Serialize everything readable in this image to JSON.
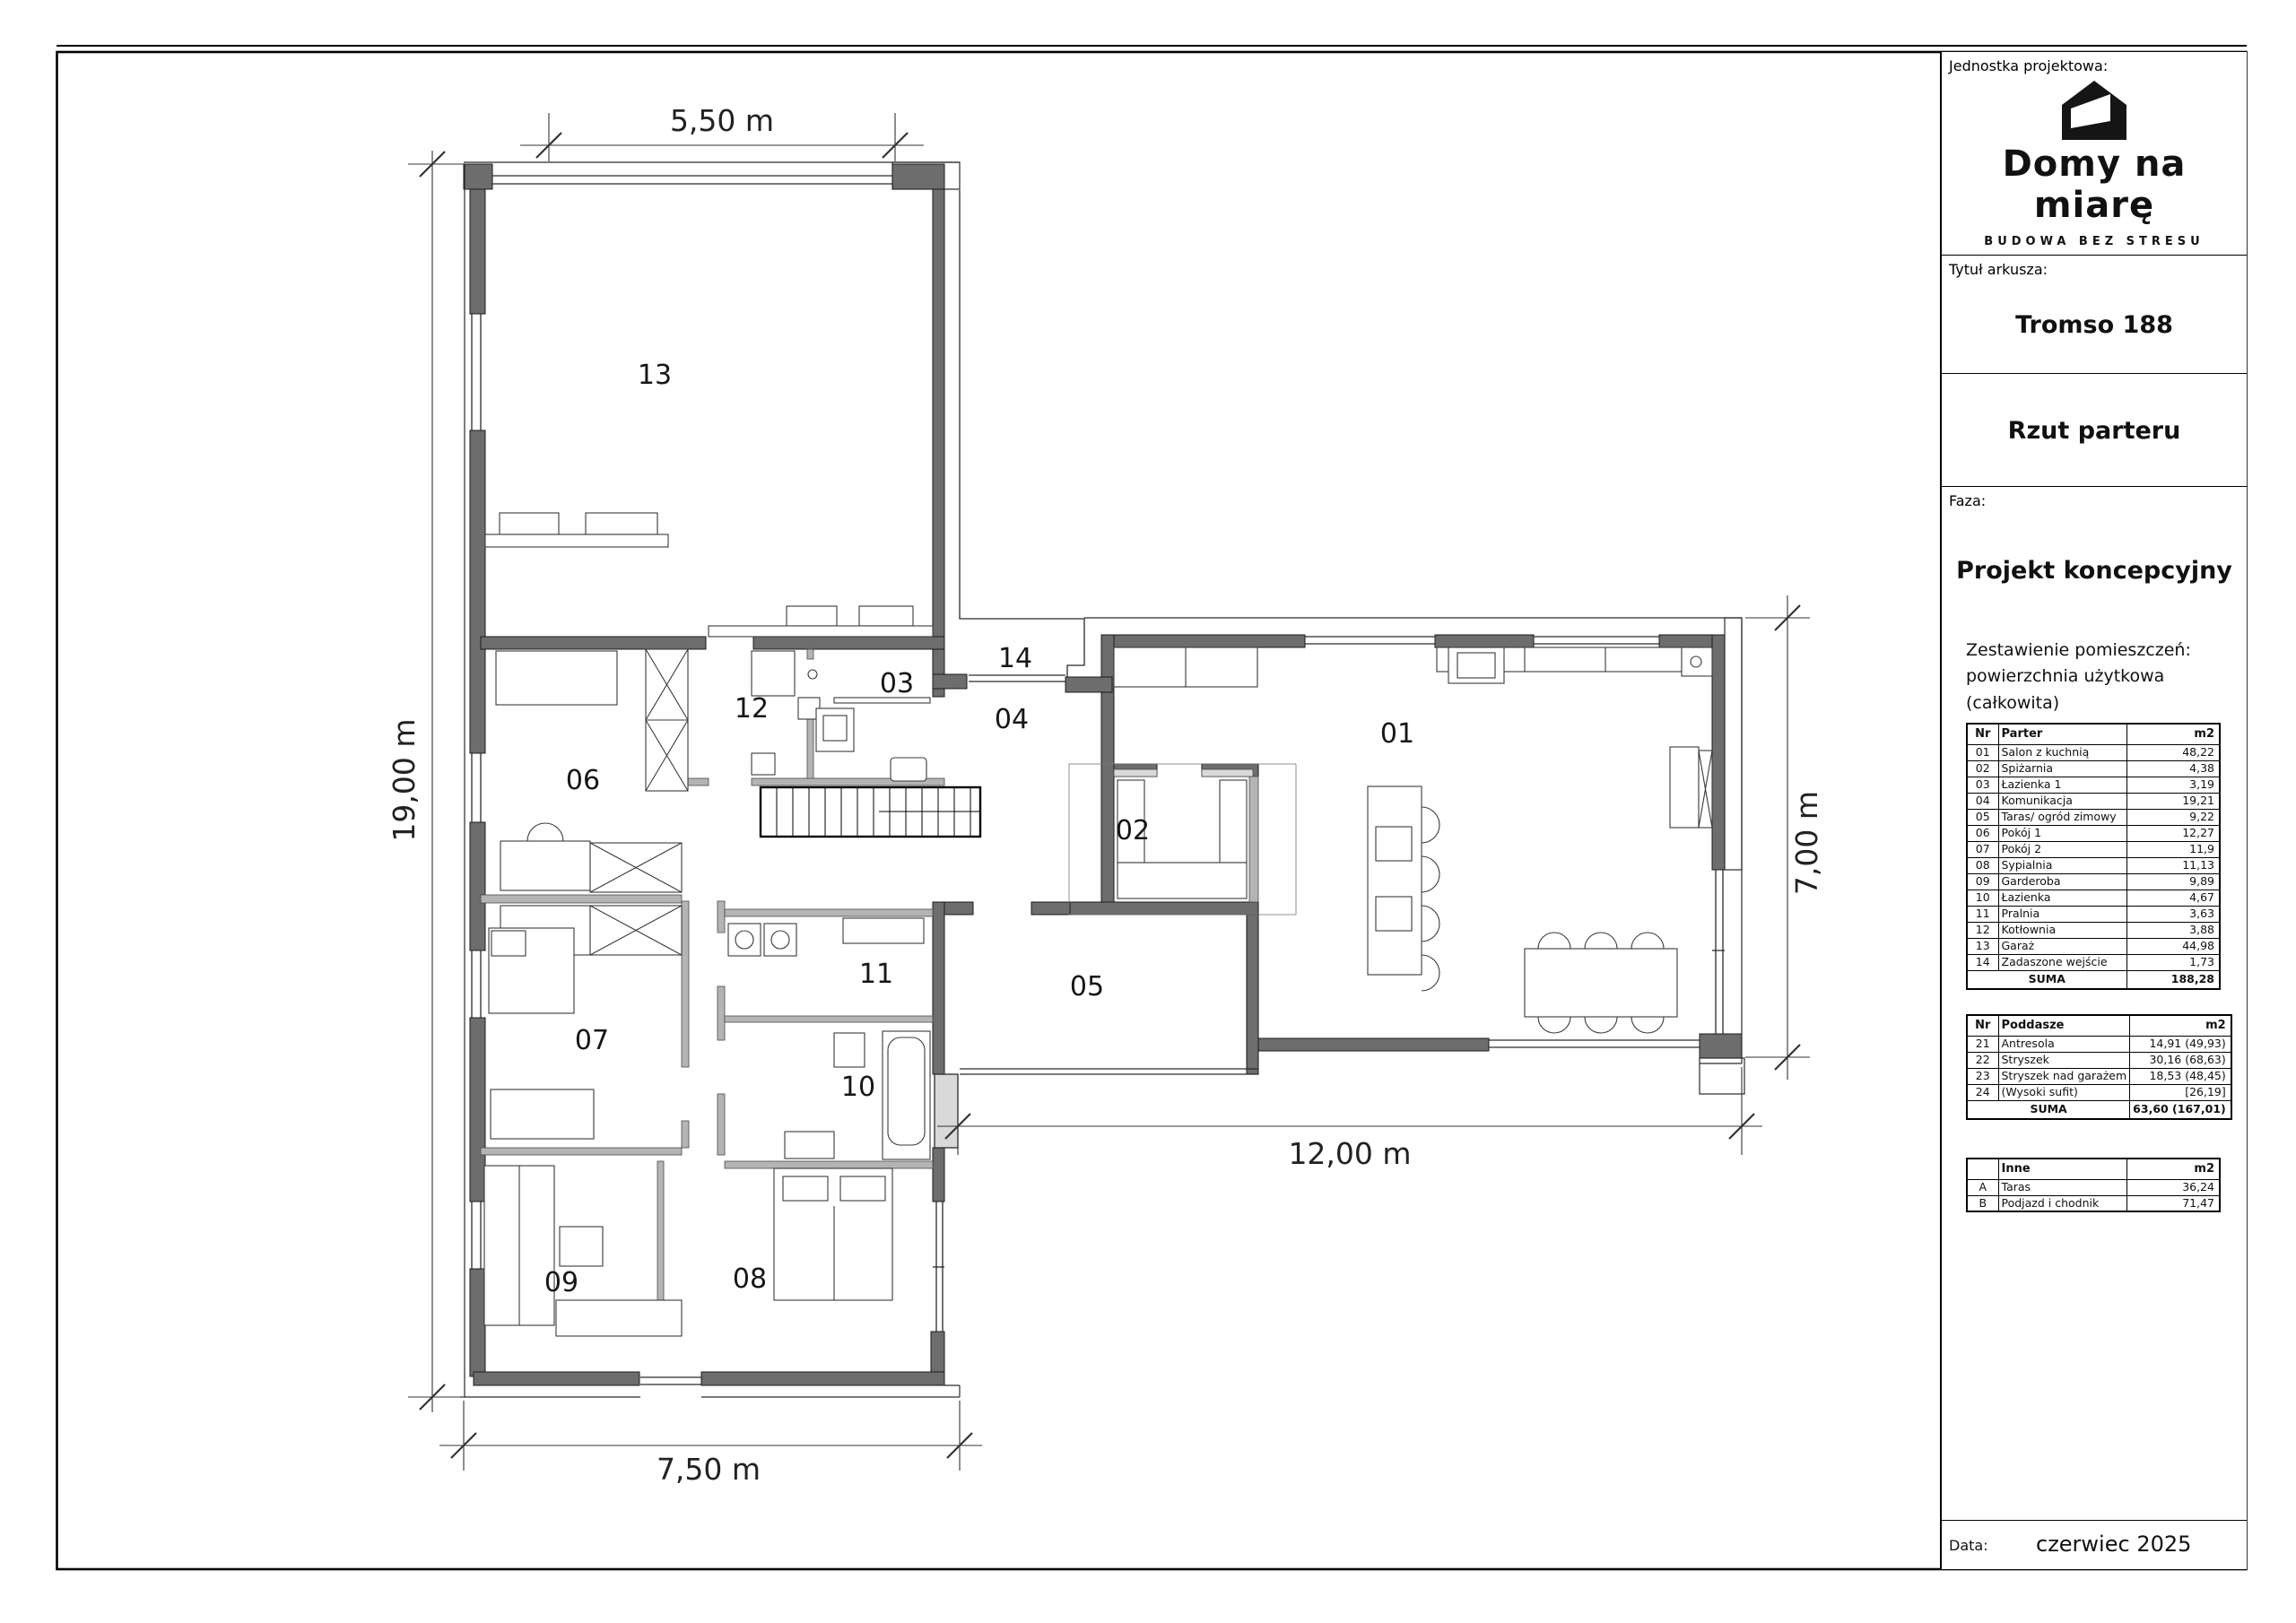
{
  "titleblock": {
    "jednostka_label": "Jednostka projektowa:",
    "brand_name": "Domy na miarę",
    "brand_tagline": "BUDOWA BEZ STRESU",
    "tytul_label": "Tytuł arkusza:",
    "sheet_name": "Tromso 188",
    "drawing_title": "Rzut parteru",
    "faza_label": "Faza:",
    "phase": "Projekt koncepcyjny",
    "zestawienie_line1": "Zestawienie pomieszczeń:",
    "zestawienie_line2": "powierzchnia użytkowa (całkowita)",
    "data_label": "Data:",
    "date_value": "czerwiec 2025"
  },
  "tables": {
    "parter": {
      "headers": [
        "Nr",
        "Parter",
        "m2"
      ],
      "rows": [
        [
          "01",
          "Salon z kuchnią",
          "48,22"
        ],
        [
          "02",
          "Spiżarnia",
          "4,38"
        ],
        [
          "03",
          "Łazienka 1",
          "3,19"
        ],
        [
          "04",
          "Komunikacja",
          "19,21"
        ],
        [
          "05",
          "Taras/ ogród zimowy",
          "9,22"
        ],
        [
          "06",
          "Pokój 1",
          "12,27"
        ],
        [
          "07",
          "Pokój 2",
          "11,9"
        ],
        [
          "08",
          "Sypialnia",
          "11,13"
        ],
        [
          "09",
          "Garderoba",
          "9,89"
        ],
        [
          "10",
          "Łazienka",
          "4,67"
        ],
        [
          "11",
          "Pralnia",
          "3,63"
        ],
        [
          "12",
          "Kotłownia",
          "3,88"
        ],
        [
          "13",
          "Garaż",
          "44,98"
        ],
        [
          "14",
          "Zadaszone wejście",
          "1,73"
        ]
      ],
      "suma_label": "SUMA",
      "suma_value": "188,28"
    },
    "poddasze": {
      "headers": [
        "Nr",
        "Poddasze",
        "m2"
      ],
      "rows": [
        [
          "21",
          "Antresola",
          "14,91 (49,93)"
        ],
        [
          "22",
          "Stryszek",
          "30,16 (68,63)"
        ],
        [
          "23",
          "Stryszek nad garażem",
          "18,53 (48,45)"
        ],
        [
          "24",
          "(Wysoki sufit)",
          "[26,19]"
        ]
      ],
      "suma_label": "SUMA",
      "suma_value": "63,60 (167,01)"
    },
    "inne": {
      "headers": [
        "",
        "Inne",
        "m2"
      ],
      "rows": [
        [
          "A",
          "Taras",
          "36,24"
        ],
        [
          "B",
          "Podjazd i chodnik",
          "71,47"
        ]
      ]
    }
  },
  "plan": {
    "room_labels": {
      "r01": "01",
      "r02": "02",
      "r03": "03",
      "r04": "04",
      "r05": "05",
      "r06": "06",
      "r07": "07",
      "r08": "08",
      "r09": "09",
      "r10": "10",
      "r11": "11",
      "r12": "12",
      "r13": "13",
      "r14": "14"
    },
    "dimensions": {
      "garage_width": "5,50 m",
      "left_height": "19,00 m",
      "bottom_width": "7,50 m",
      "wing_width": "12,00 m",
      "wing_height": "7,00 m"
    }
  }
}
